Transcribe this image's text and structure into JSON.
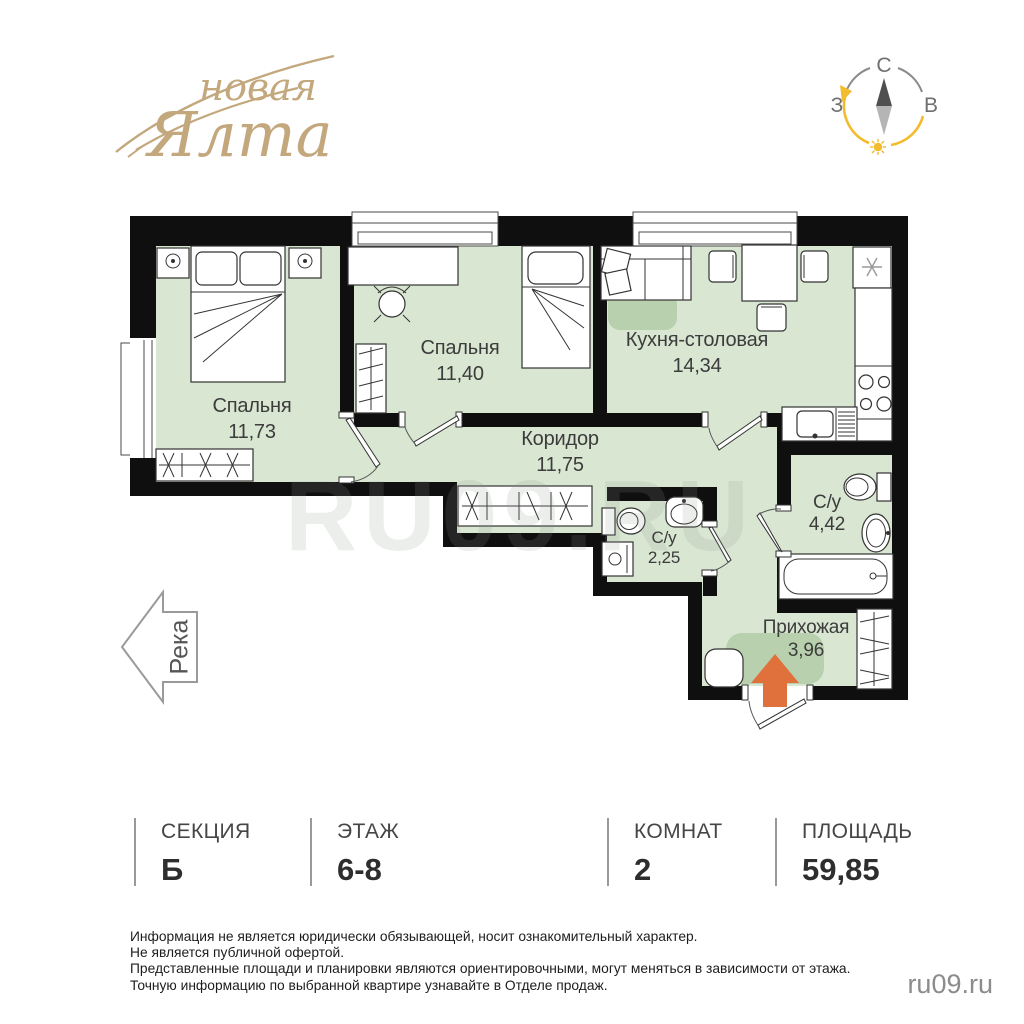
{
  "logo": {
    "word1": "новая",
    "word2": "Ялта"
  },
  "compass": {
    "north": "С",
    "west": "З",
    "east": "В"
  },
  "river": {
    "label": "Река"
  },
  "plan": {
    "watermark": "RU09.RU",
    "rooms": [
      {
        "name": "Спальня",
        "area": "11,73"
      },
      {
        "name": "Спальня",
        "area": "11,40"
      },
      {
        "name": "Кухня-столовая",
        "area": "14,34"
      },
      {
        "name": "Коридор",
        "area": "11,75"
      },
      {
        "name": "С/у",
        "area": "2,25"
      },
      {
        "name": "С/у",
        "area": "4,42"
      },
      {
        "name": "Прихожая",
        "area": "3,96"
      }
    ]
  },
  "summary": {
    "columns": [
      {
        "label": "СЕКЦИЯ",
        "value": "Б"
      },
      {
        "label": "ЭТАЖ",
        "value": "6-8"
      },
      {
        "label": "КОМНАТ",
        "value": "2"
      },
      {
        "label": "ПЛОЩАДЬ",
        "value": "59,85"
      }
    ]
  },
  "disclaimer": {
    "line1": "Информация не является юридически обязывающей, носит ознакомительный характер.",
    "line2": "Не является публичной офертой.",
    "line3": "Представленные площади и планировки являются ориентировочными, могут меняться в зависимости от этажа.",
    "line4": "Точную информацию по выбранной квартире узнавайте в Отделе продаж."
  },
  "site": {
    "watermark": "ru09.ru"
  },
  "colors": {
    "floor_green": "#d8e6d2",
    "rug_green": "#b8d0ad",
    "wall_black": "#0f0f0f",
    "entry_arrow_orange": "#e0703c",
    "logo_beige": "#c3a87d",
    "compass_yellow": "#f3bc2e",
    "label_gray": "#3c3c3c"
  }
}
